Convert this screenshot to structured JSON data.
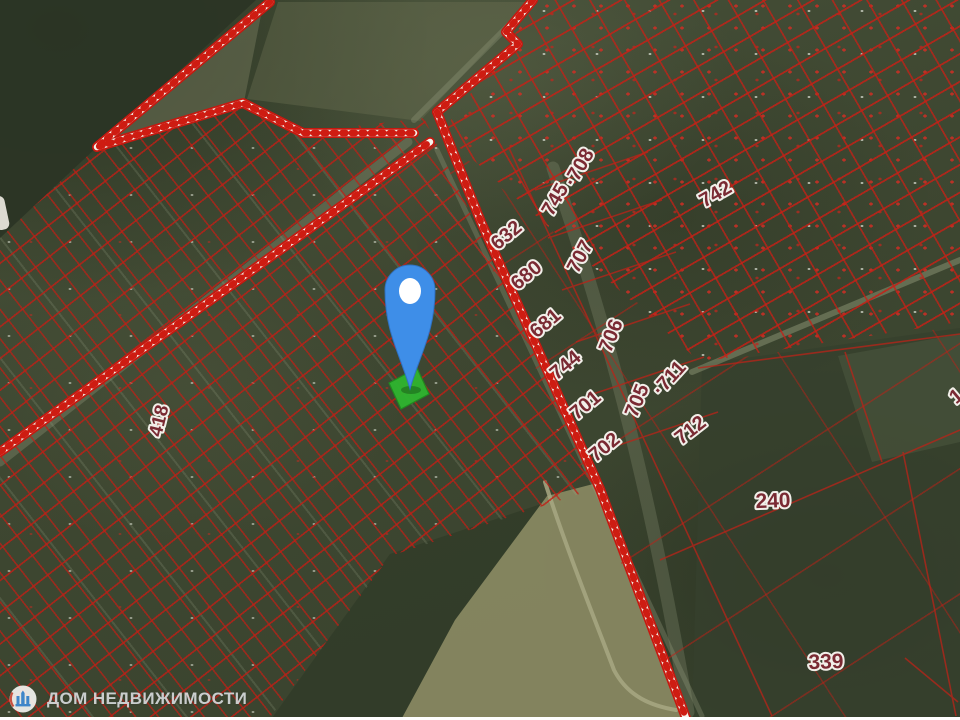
{
  "brand": {
    "name": "ДОМ НЕДВИЖИМОСТИ",
    "logo_icon": "building-logo-icon"
  },
  "map": {
    "type": "satellite-cadastral",
    "colors": {
      "parcel_line": "#c01e14",
      "boundary_stripe_red": "#ce1c12",
      "boundary_stripe_white": "#f4f2ea",
      "selected_parcel_green": "#2fb52f",
      "pin_blue": "#3e8ee8",
      "label_text": "#7a2a33",
      "label_halo": "#f2efe9"
    },
    "pin": {
      "icon": "location-pin-icon",
      "x": 410,
      "y": 389
    },
    "selected_parcel": {
      "x": 409,
      "y": 388
    },
    "parcel_labels": [
      {
        "text": "418",
        "x": 160,
        "y": 421,
        "rot": -76,
        "size": 19
      },
      {
        "text": "632",
        "x": 507,
        "y": 236,
        "rot": -40,
        "size": 20
      },
      {
        "text": "680",
        "x": 527,
        "y": 276,
        "rot": -40,
        "size": 20
      },
      {
        "text": "681",
        "x": 546,
        "y": 324,
        "rot": -40,
        "size": 20
      },
      {
        "text": "744",
        "x": 566,
        "y": 366,
        "rot": -40,
        "size": 20
      },
      {
        "text": "701",
        "x": 586,
        "y": 406,
        "rot": -40,
        "size": 20
      },
      {
        "text": "702",
        "x": 605,
        "y": 448,
        "rot": -40,
        "size": 20
      },
      {
        "text": "745",
        "x": 556,
        "y": 200,
        "rot": -60,
        "size": 20
      },
      {
        "text": "·708",
        "x": 580,
        "y": 168,
        "rot": -60,
        "size": 20
      },
      {
        "text": "707",
        "x": 581,
        "y": 257,
        "rot": -62,
        "size": 20
      },
      {
        "text": "706",
        "x": 612,
        "y": 336,
        "rot": -68,
        "size": 20
      },
      {
        "text": "705",
        "x": 638,
        "y": 401,
        "rot": -68,
        "size": 20
      },
      {
        "text": "·711",
        "x": 670,
        "y": 379,
        "rot": -48,
        "size": 20
      },
      {
        "text": "712",
        "x": 691,
        "y": 431,
        "rot": -38,
        "size": 20
      },
      {
        "text": "742",
        "x": 716,
        "y": 195,
        "rot": -30,
        "size": 20
      },
      {
        "text": "240",
        "x": 773,
        "y": 502,
        "rot": -2,
        "size": 21
      },
      {
        "text": "339",
        "x": 826,
        "y": 663,
        "rot": -2,
        "size": 21
      },
      {
        "text": "1",
        "x": 957,
        "y": 397,
        "rot": -40,
        "size": 20
      }
    ]
  }
}
